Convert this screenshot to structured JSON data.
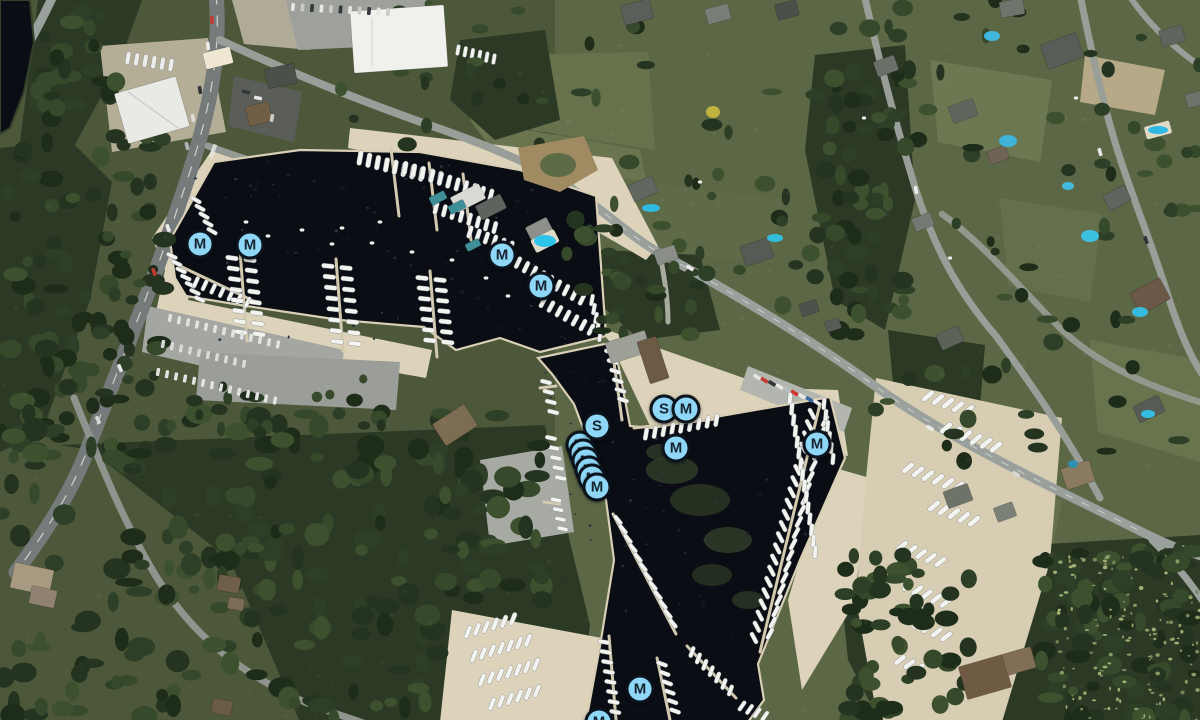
{
  "map": {
    "view": "satellite",
    "marker_styles": {
      "fill": "#8ed7f7",
      "ring": "#0b131c",
      "letter": "#17242f"
    },
    "markers": [
      {
        "label": "M",
        "x": 200,
        "y": 244
      },
      {
        "label": "M",
        "x": 250,
        "y": 245
      },
      {
        "label": "M",
        "x": 502,
        "y": 255
      },
      {
        "label": "M",
        "x": 541,
        "y": 286
      },
      {
        "label": "M",
        "x": 580,
        "y": 445,
        "occluded": true
      },
      {
        "label": "M",
        "x": 583,
        "y": 453,
        "occluded": true
      },
      {
        "label": "M",
        "x": 586,
        "y": 461,
        "occluded": true
      },
      {
        "label": "M",
        "x": 589,
        "y": 470,
        "occluded": true
      },
      {
        "label": "M",
        "x": 592,
        "y": 478,
        "occluded": true
      },
      {
        "label": "M",
        "x": 597,
        "y": 487
      },
      {
        "label": "S",
        "x": 597,
        "y": 426
      },
      {
        "label": "S",
        "x": 664,
        "y": 409
      },
      {
        "label": "M",
        "x": 686,
        "y": 409
      },
      {
        "label": "M",
        "x": 676,
        "y": 448
      },
      {
        "label": "M",
        "x": 817,
        "y": 444
      },
      {
        "label": "M",
        "x": 640,
        "y": 689
      },
      {
        "label": "M",
        "x": 599,
        "y": 722,
        "partial": true
      }
    ]
  }
}
